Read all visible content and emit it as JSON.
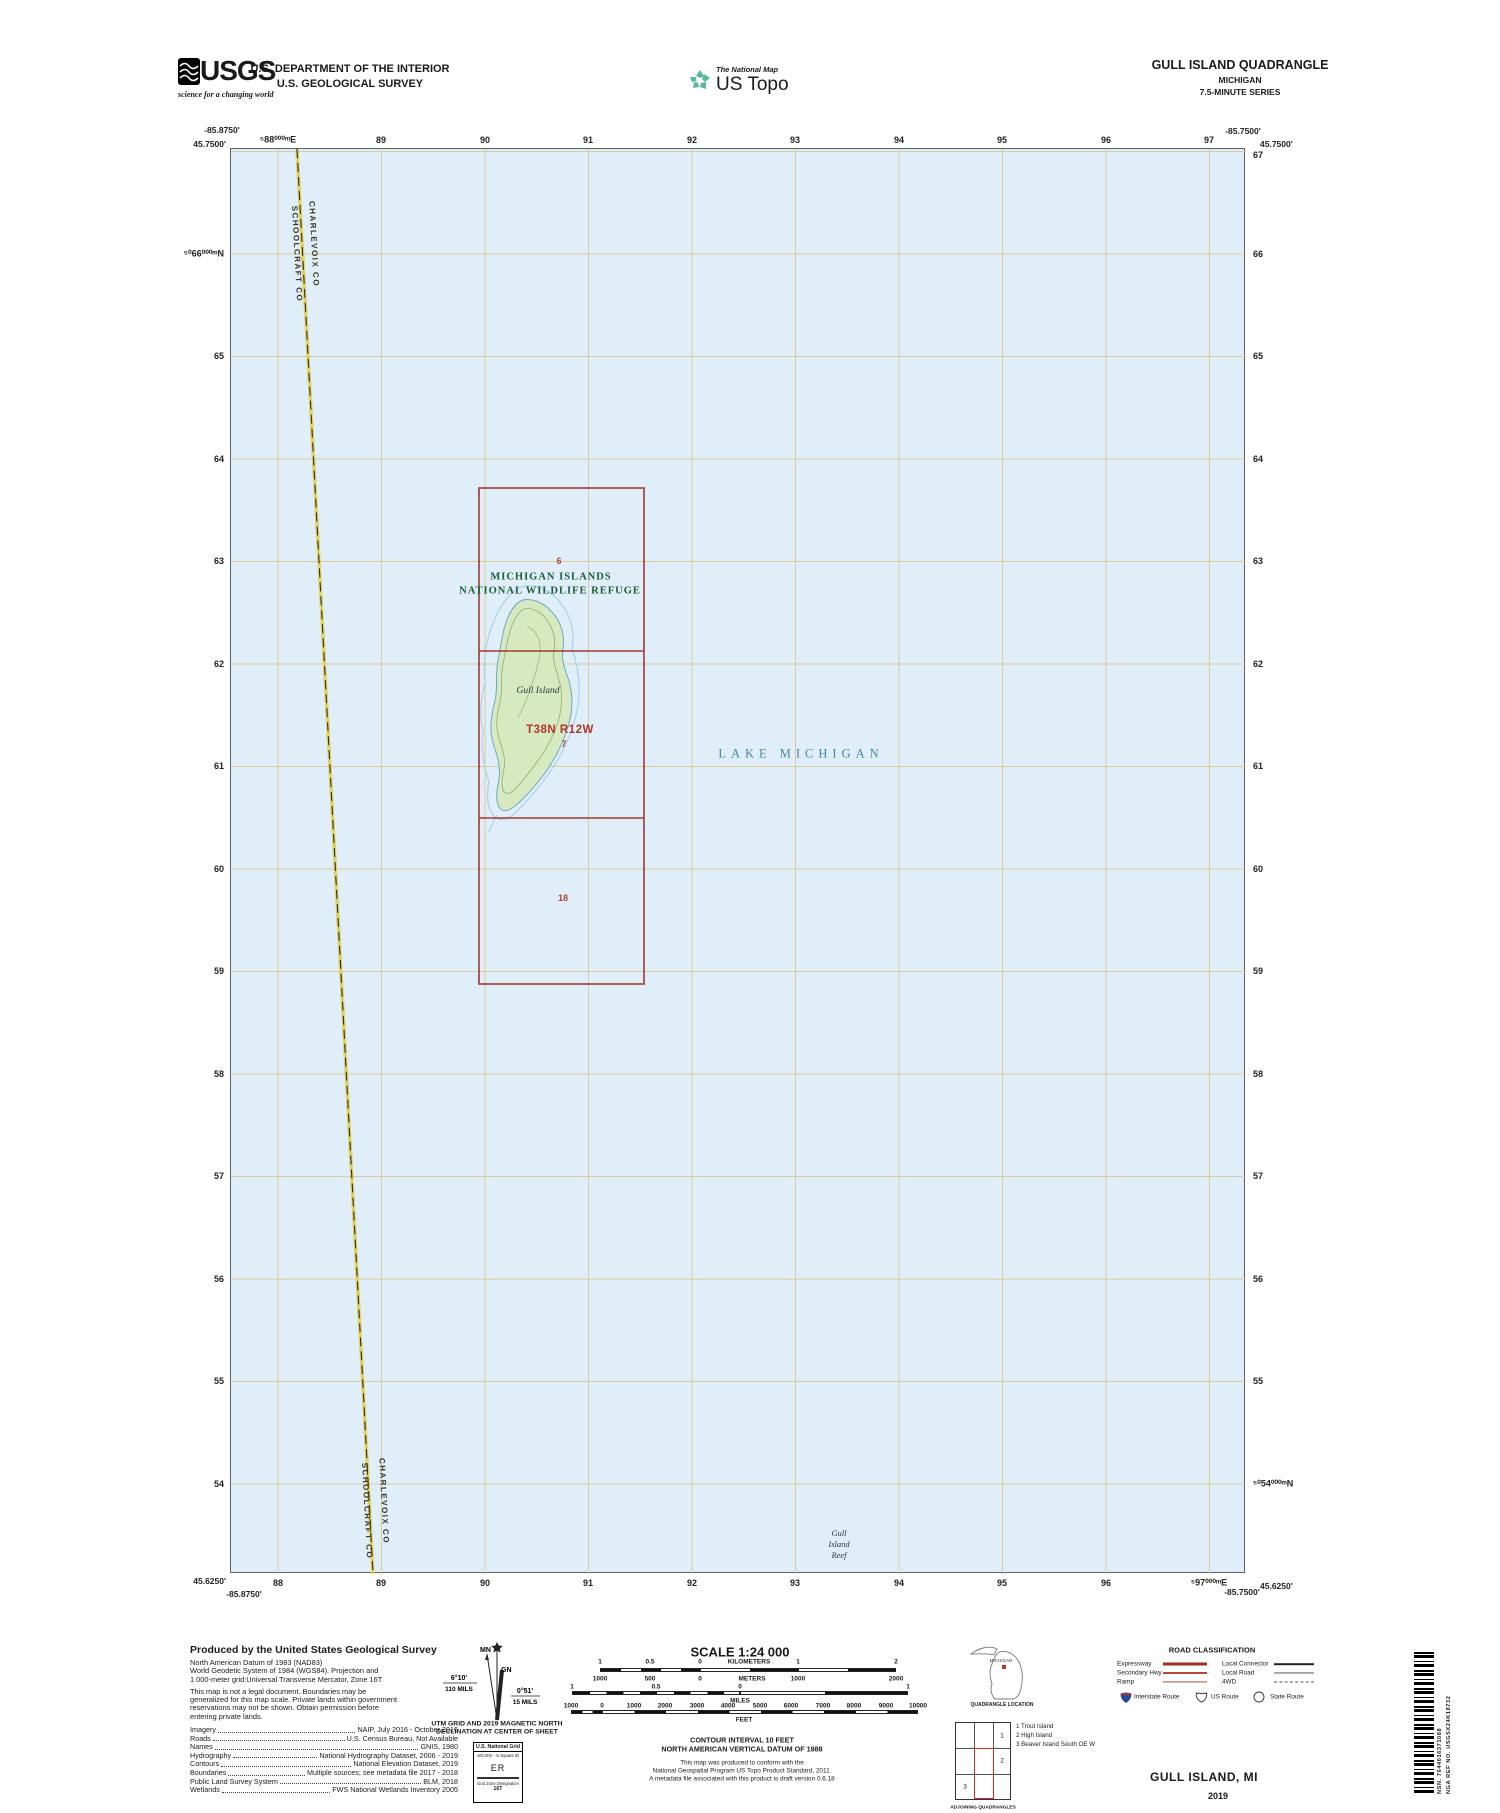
{
  "colors": {
    "lake": "#dfeef9",
    "island": "#d6e9c0",
    "grid": "#d8c993",
    "boundary_red": "#a03a2c",
    "refuge_green": "#1c5c34",
    "water_label": "#47889f",
    "county_yellow": "#e3cf4e"
  },
  "header": {
    "usgs_logo": "USGS",
    "usgs_tagline": "science for a changing world",
    "dept_line1": "U.S. DEPARTMENT OF THE INTERIOR",
    "dept_line2": "U.S. GEOLOGICAL SURVEY",
    "ustopo_tagline": "The National Map",
    "ustopo_brand": "US Topo",
    "quad_title": "GULL ISLAND QUADRANGLE",
    "quad_state": "MICHIGAN",
    "quad_series": "7.5-MINUTE SERIES"
  },
  "map": {
    "corners": {
      "tl_lat": "45.7500'",
      "tl_lon": "-85.8750'",
      "tr_lat": "45.7500'",
      "tr_lon": "-85.7500'",
      "bl_lat": "45.6250'",
      "bl_lon": "-85.8750'",
      "br_lat": "45.6250'",
      "br_lon": "-85.7500'"
    },
    "ticks_top": [
      "⁵88⁰⁰⁰ᵐE",
      "89",
      "90",
      "91",
      "92",
      "93",
      "94",
      "95",
      "96",
      "97"
    ],
    "ticks_bottom": [
      "88",
      "89",
      "90",
      "91",
      "92",
      "93",
      "94",
      "95",
      "96",
      "⁵97⁰⁰⁰ᵐE"
    ],
    "ticks_left": [
      "⁵⁰66⁰⁰⁰ᵐN",
      "65",
      "64",
      "63",
      "62",
      "61",
      "60",
      "59",
      "58",
      "57",
      "56",
      "55",
      "54"
    ],
    "ticks_right": [
      "67",
      "66",
      "65",
      "64",
      "63",
      "62",
      "61",
      "60",
      "59",
      "58",
      "57",
      "56",
      "55",
      "⁵⁰54⁰⁰⁰ᵐN"
    ],
    "labels": {
      "refuge1": "MICHIGAN ISLANDS",
      "refuge2": "NATIONAL WILDLIFE REFUGE",
      "lake": "LAKE MICHIGAN",
      "island": "Gull Island",
      "township": "T38N R12W",
      "sec6": "6",
      "sec7": "7",
      "sec18": "18",
      "reef1": "Gull",
      "reef2": "Island",
      "reef3": "Reef",
      "county_e": "CHARLEVOIX CO",
      "county_w": "SCHOOLCRAFT CO"
    }
  },
  "footer": {
    "produced_title": "Produced by the United States Geological Survey",
    "datum_lines": [
      "North American Datum of 1983 (NAD83)",
      "World Geodetic System of 1984 (WGS84).  Projection and",
      "1 000-meter grid:Universal Transverse Mercator, Zone 16T"
    ],
    "legal_lines": [
      "This map is not a legal document. Boundaries may be",
      "generalized for this map scale. Private lands within government",
      "reservations may not be shown. Obtain permission before",
      "entering private lands."
    ],
    "credits": [
      {
        "label": "Imagery",
        "value": "NAIP, July 2016 - October 2016"
      },
      {
        "label": "Roads",
        "value": "U.S. Census Bureau, Not Available"
      },
      {
        "label": "Names",
        "value": "GNIS, 1980"
      },
      {
        "label": "Hydrography",
        "value": "National Hydrography Dataset, 2006 - 2019"
      },
      {
        "label": "Contours",
        "value": "National Elevation Dataset, 2019"
      },
      {
        "label": "Boundaries",
        "value": "Multiple sources; see metadata file 2017 - 2018"
      },
      {
        "label": "Public Land Survey System",
        "value": "BLM, 2018"
      },
      {
        "label": "Wetlands",
        "value": "FWS National Wetlands Inventory 2005"
      }
    ],
    "declination": {
      "mn": "MN",
      "gn": "GN",
      "star": "★",
      "left_deg": "6°10'",
      "left_mils": "110 MILS",
      "right_deg": "0°51'",
      "right_mils": "15 MILS",
      "caption1": "UTM GRID AND 2019 MAGNETIC NORTH",
      "caption2": "DECLINATION AT CENTER OF SHEET"
    },
    "usng": {
      "title": "U.S. National Grid",
      "sub": "100,000 - m Square ID",
      "square": "ER",
      "zone_label": "Grid Zone Designation",
      "zone": "16T"
    },
    "scale": {
      "title": "SCALE 1:24 000",
      "km_labels": [
        "1",
        "0.5",
        "0",
        "KILOMETERS",
        "1",
        "2"
      ],
      "m_labels": [
        "1000",
        "500",
        "0",
        "METERS",
        "1000",
        "2000"
      ],
      "mi_labels": [
        "1",
        "0.5",
        "0",
        "MILES",
        "1"
      ],
      "ft_labels": [
        "1000",
        "0",
        "1000",
        "2000",
        "3000",
        "4000",
        "5000",
        "6000",
        "7000",
        "8000",
        "9000",
        "10000"
      ],
      "ft_unit": "FEET"
    },
    "contour1": "CONTOUR INTERVAL 10 FEET",
    "contour2": "NORTH AMERICAN VERTICAL DATUM OF 1988",
    "note_lines": [
      "This map was produced to conform with the",
      "National Geospatial Program US Topo Product Standard, 2011.",
      "A metadata file associated with this product is draft version 0.6.18"
    ],
    "location": {
      "state": "MICHIGAN",
      "caption": "QUADRANGLE LOCATION"
    },
    "adjoining": {
      "caption": "ADJOINING QUADRANGLES",
      "n1": "1",
      "n2": "2",
      "n3": "3",
      "legend": [
        "1 Trout Island",
        "2 High Island",
        "3 Beaver Island South OE W"
      ]
    },
    "roads": {
      "title": "ROAD CLASSIFICATION",
      "rows_left": [
        "Expressway",
        "Secondary Hwy",
        "Ramp"
      ],
      "rows_right": [
        "Local Connector",
        "Local Road",
        "4WD"
      ],
      "shields": [
        "Interstate Route",
        "US Route",
        "State Route"
      ]
    },
    "map_name": "GULL ISLAND,  MI",
    "year": "2019",
    "nsn": "NSN.  7644016371088",
    "nga": "NGA REF NO.  USGSX24K18732"
  }
}
